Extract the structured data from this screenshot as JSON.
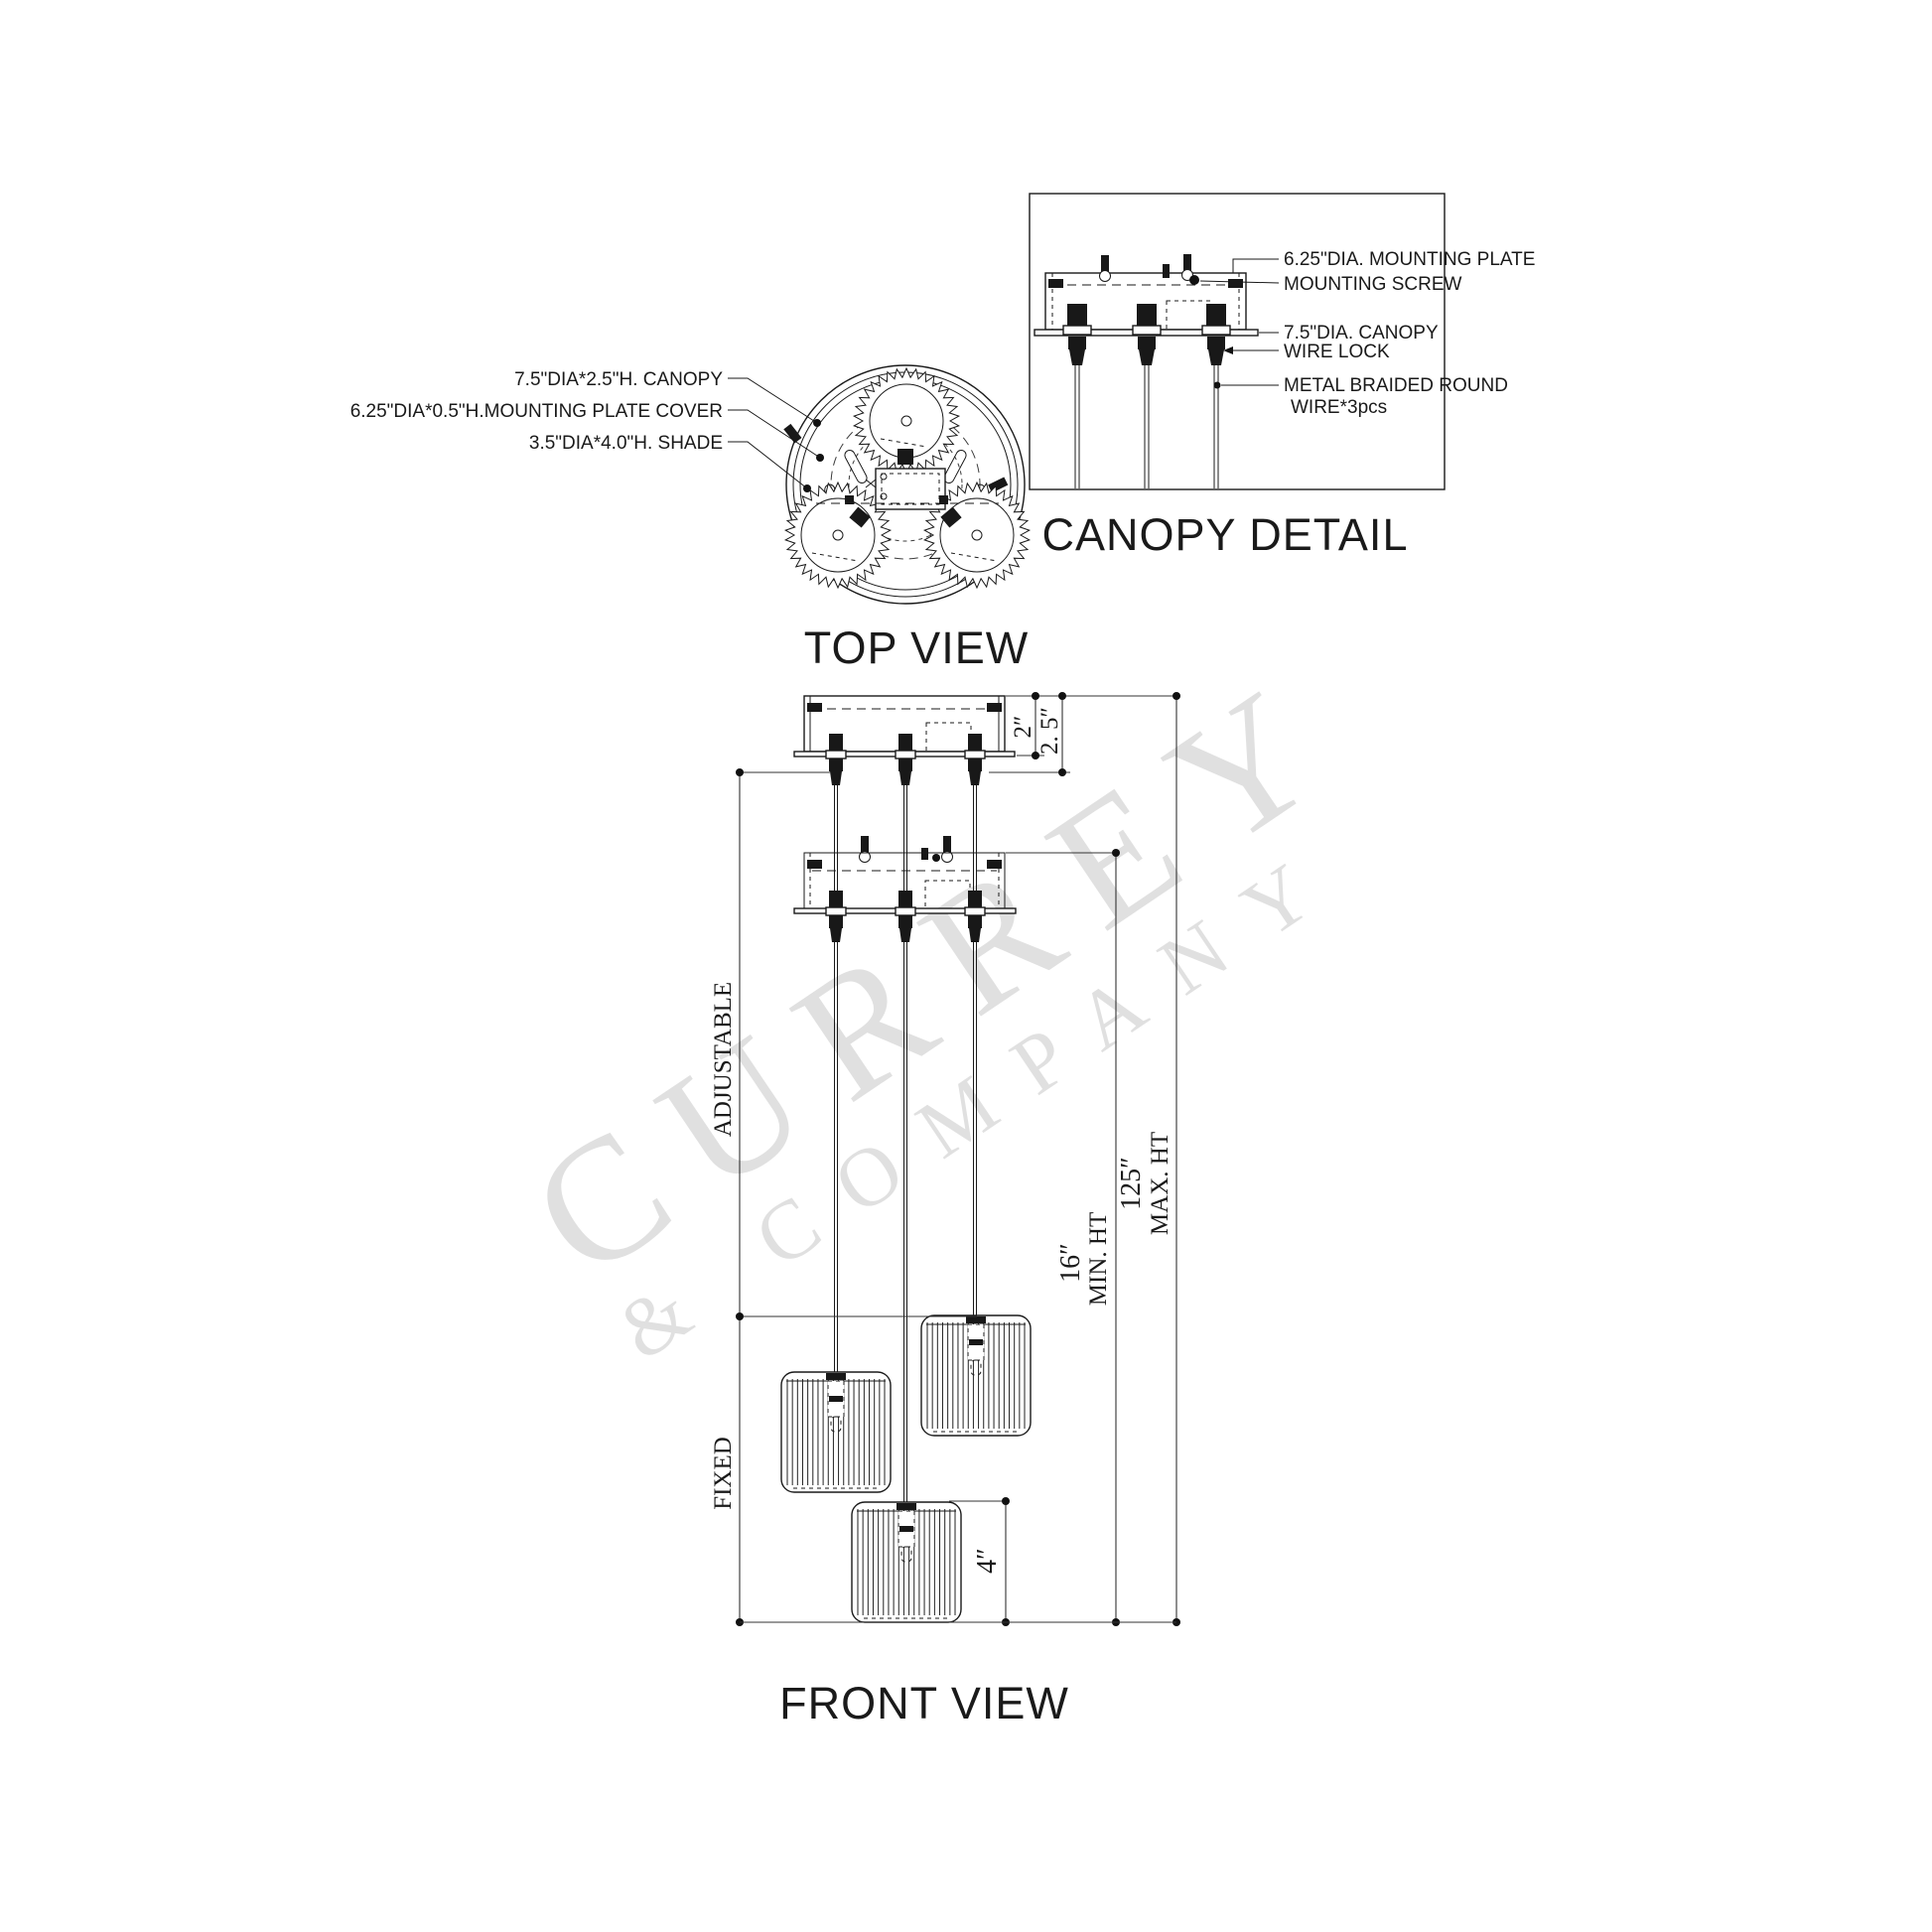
{
  "watermark": {
    "primary": "CURREY",
    "secondary": "& COMPANY"
  },
  "top_view": {
    "title": "TOP VIEW",
    "label_canopy": "7.5\"DIA*2.5\"H. CANOPY",
    "label_mounting_plate_cover": "6.25\"DIA*0.5\"H.MOUNTING PLATE  COVER",
    "label_shade": "3.5\"DIA*4.0\"H. SHADE"
  },
  "canopy_detail": {
    "title": "CANOPY DETAIL",
    "label_mounting_plate": "6.25\"DIA.  MOUNTING PLATE",
    "label_mounting_screw": "MOUNTING SCREW",
    "label_canopy": "7.5\"DIA. CANOPY",
    "label_wire_lock": "WIRE LOCK",
    "label_wire_line1": "METAL BRAIDED ROUND",
    "label_wire_line2": "WIRE*3pcs"
  },
  "front_view": {
    "title": "FRONT VIEW",
    "dim_canopy_plate_height": "2″",
    "dim_canopy_total_height": "2. 5″",
    "dim_adjustable": "ADJUSTABLE",
    "dim_fixed": "FIXED",
    "dim_min_height": "16″",
    "dim_min_height_label": "MIN. HT",
    "dim_max_height": "125″",
    "dim_max_height_label": "MAX. HT",
    "dim_shade_height": "4″"
  }
}
